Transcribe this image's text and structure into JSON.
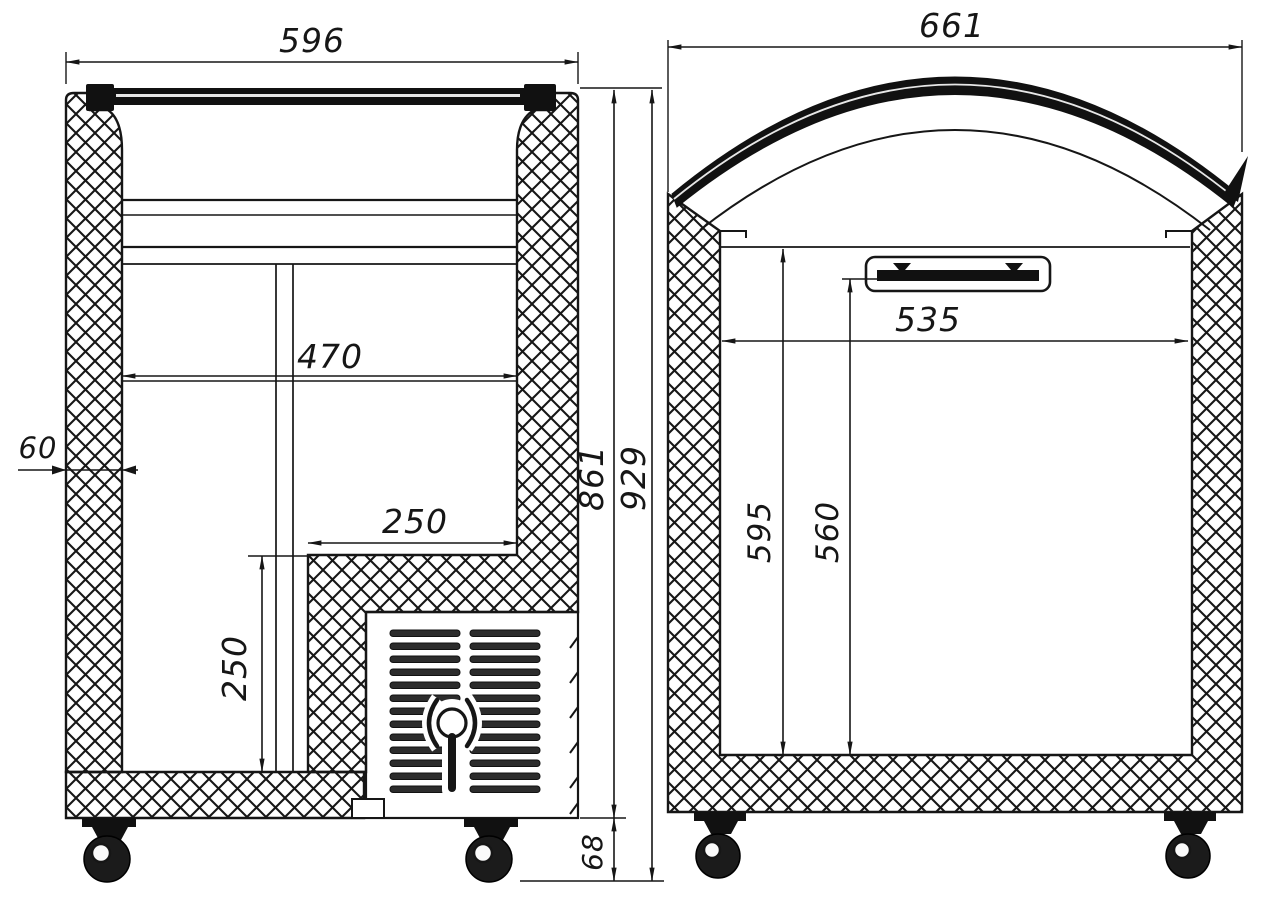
{
  "drawing": {
    "background": "#ffffff",
    "line_color": "#161616",
    "views": {
      "left": {
        "label": "side-section-view",
        "dims": {
          "overall_width": {
            "value": "596",
            "orientation": "horizontal"
          },
          "wall_thickness": {
            "value": "60",
            "orientation": "horizontal"
          },
          "interior_width": {
            "value": "470",
            "orientation": "horizontal"
          },
          "niche_width": {
            "value": "250",
            "orientation": "horizontal"
          },
          "niche_height": {
            "value": "250",
            "orientation": "vertical"
          },
          "body_height": {
            "value": "861",
            "orientation": "vertical"
          },
          "overall_height": {
            "value": "929",
            "orientation": "vertical"
          },
          "caster_height": {
            "value": "68",
            "orientation": "vertical"
          }
        }
      },
      "right": {
        "label": "front-section-view",
        "dims": {
          "overall_width": {
            "value": "661",
            "orientation": "horizontal"
          },
          "opening_width": {
            "value": "535",
            "orientation": "horizontal"
          },
          "interior_height_rear": {
            "value": "595",
            "orientation": "vertical"
          },
          "interior_height_front": {
            "value": "560",
            "orientation": "vertical"
          }
        }
      }
    }
  }
}
